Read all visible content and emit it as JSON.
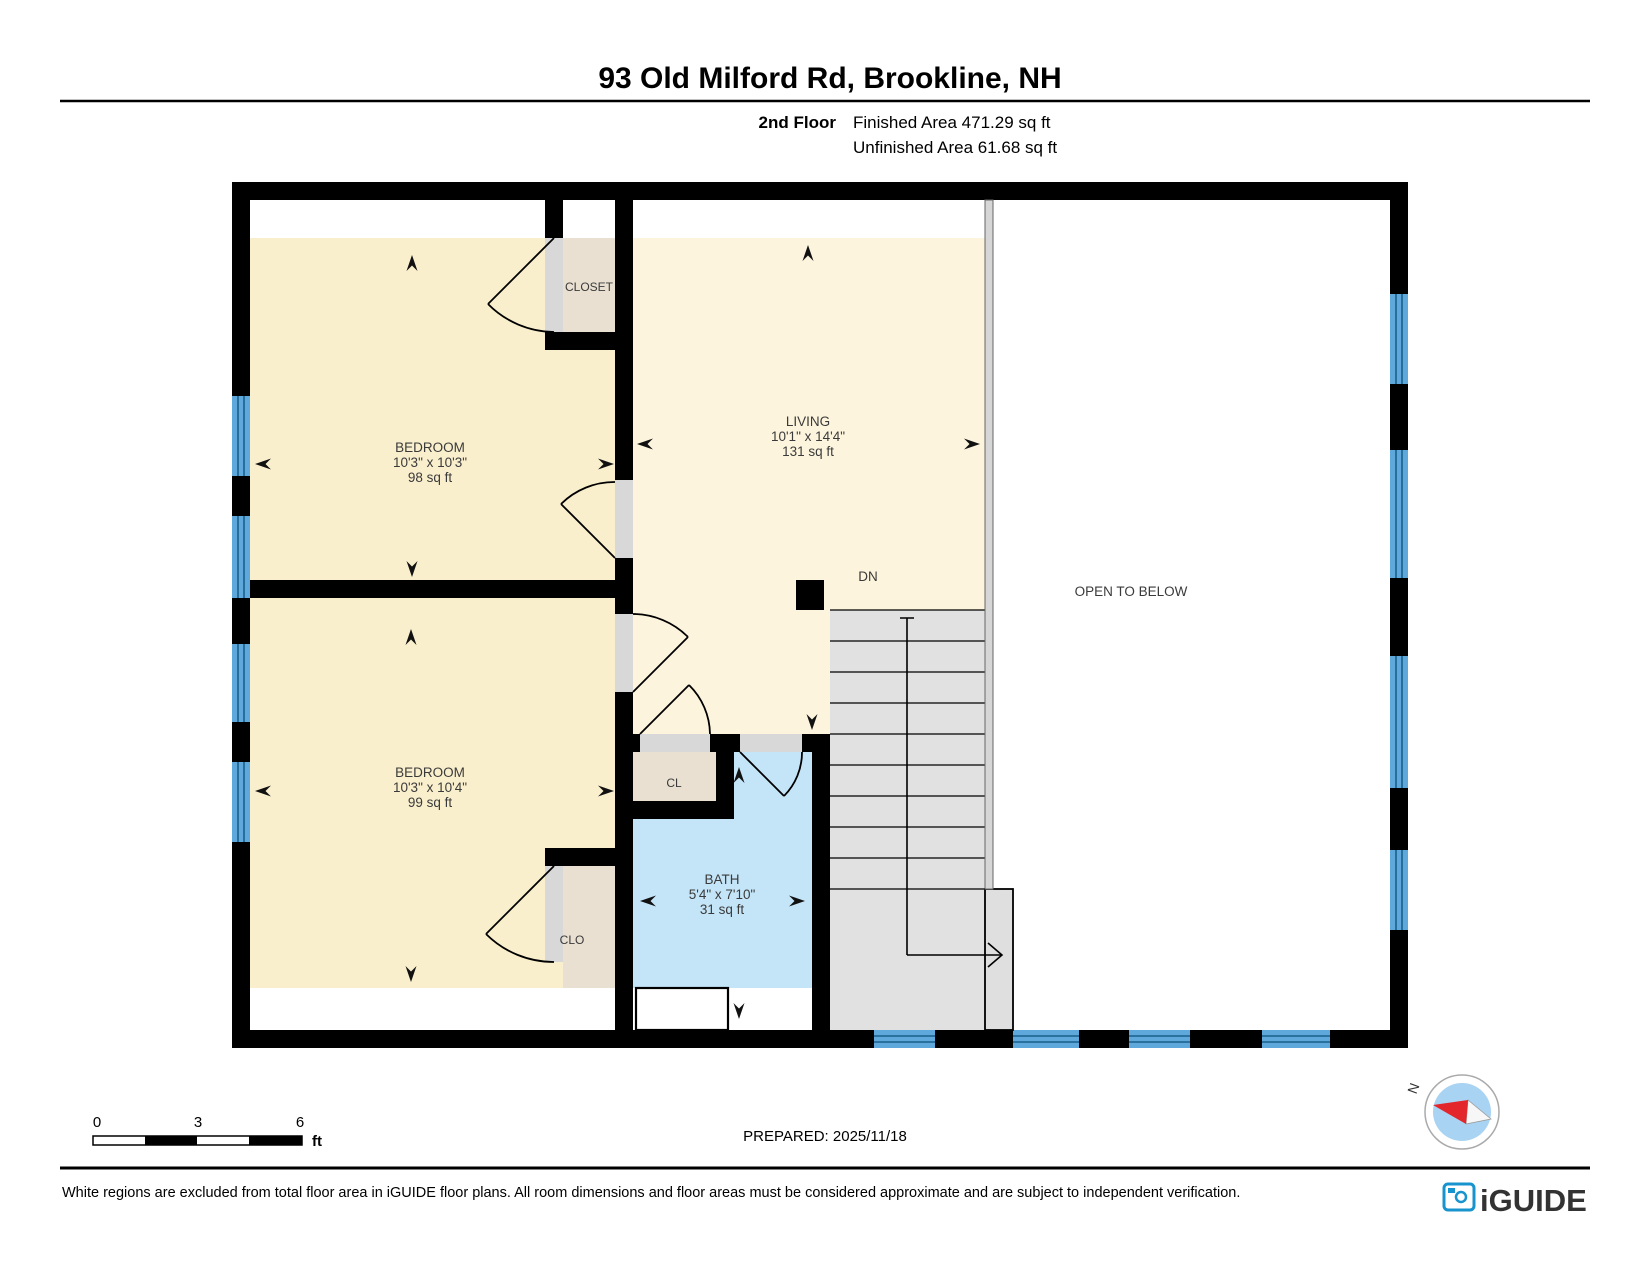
{
  "header": {
    "title": "93 Old Milford Rd, Brookline, NH",
    "floor": "2nd Floor",
    "finished": "Finished Area 471.29 sq ft",
    "unfinished": "Unfinished Area 61.68 sq ft"
  },
  "rooms": [
    {
      "id": "bedroom-1",
      "name": "BEDROOM",
      "dims": "10'3\" x 10'3\"",
      "area": "98 sq ft"
    },
    {
      "id": "living",
      "name": "LIVING",
      "dims": "10'1\" x 14'4\"",
      "area": "131 sq ft"
    },
    {
      "id": "bedroom-2",
      "name": "BEDROOM",
      "dims": "10'3\" x 10'4\"",
      "area": "99 sq ft"
    },
    {
      "id": "bath",
      "name": "BATH",
      "dims": "5'4\" x 7'10\"",
      "area": "31 sq ft"
    }
  ],
  "closets": {
    "closet": "CLOSET",
    "cl": "CL",
    "clo": "CLO"
  },
  "annotations": {
    "dn": "DN",
    "open_to_below": "OPEN TO BELOW"
  },
  "scale_bar": {
    "labels": [
      "0",
      "3",
      "6"
    ],
    "unit": "ft"
  },
  "prepared": "PREPARED: 2025/11/18",
  "compass": {
    "north": "N"
  },
  "footer": {
    "disclaimer": "White regions are excluded from total floor area in iGUIDE floor plans. All room dimensions and floor areas must be considered approximate and are subject to independent verification.",
    "brand": "iGUIDE"
  },
  "colors": {
    "wall": "#000000",
    "bedroom": "#FAEFCD",
    "living": "#FCF4DD",
    "closet": "#E9E0D2",
    "bath": "#C4E5F8",
    "window": "#5FA8DC",
    "stair": "#E1E1E1",
    "railing": "#D6D6D6",
    "brand": "#1793CE",
    "compass_inner": "#A9D3F2",
    "compass_needle": "#E3262B"
  }
}
